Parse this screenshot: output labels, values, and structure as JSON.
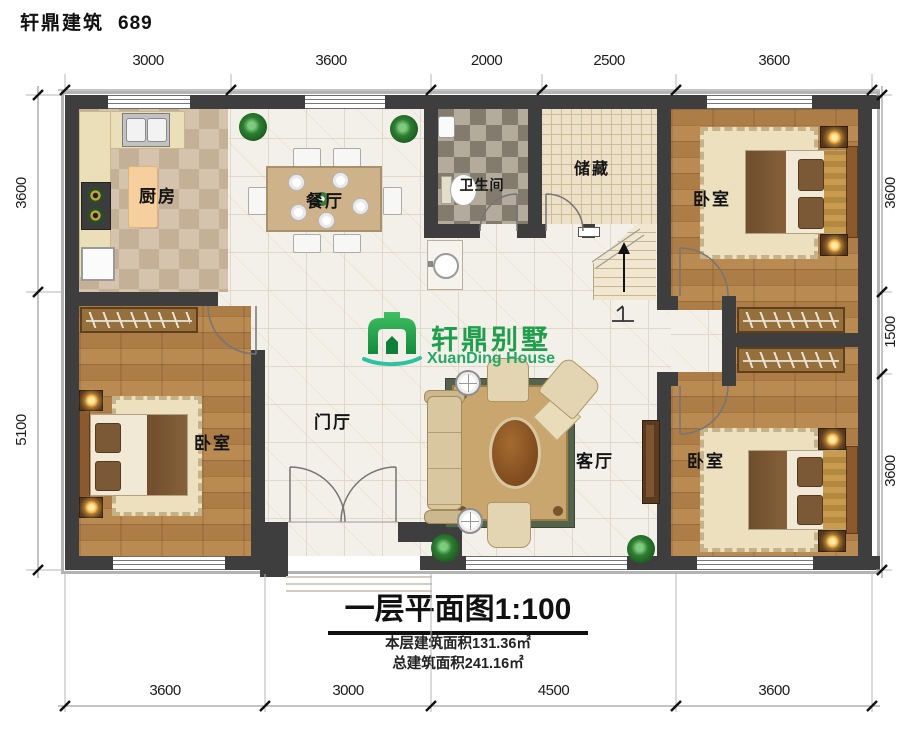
{
  "header": {
    "title": "轩鼎建筑",
    "number": "689"
  },
  "logo": {
    "name_cn": "轩鼎别墅",
    "name_en": "XuanDing House"
  },
  "colors": {
    "logo_green": "#1f9e4b",
    "logo_teal": "#2ec2a0",
    "wall": "#3f3e3e"
  },
  "rooms": {
    "kitchen": "厨房",
    "dining": "餐厅",
    "bathroom": "卫生间",
    "storage": "储藏",
    "bedroom_top_right": "卧室",
    "bedroom_bottom_left": "卧室",
    "bedroom_bottom_right": "卧室",
    "foyer": "门厅",
    "living": "客厅"
  },
  "dimensions": {
    "top": [
      "3000",
      "3600",
      "2000",
      "2500",
      "3600"
    ],
    "bottom": [
      "3600",
      "3000",
      "4500",
      "3600"
    ],
    "left": [
      "3600",
      "5100"
    ],
    "right": [
      "3600",
      "1500",
      "3600"
    ]
  },
  "titleblock": {
    "main": "一层平面图1:100",
    "floor_area": "本层建筑面积131.36㎡",
    "total_area": "总建筑面积241.16㎡"
  }
}
